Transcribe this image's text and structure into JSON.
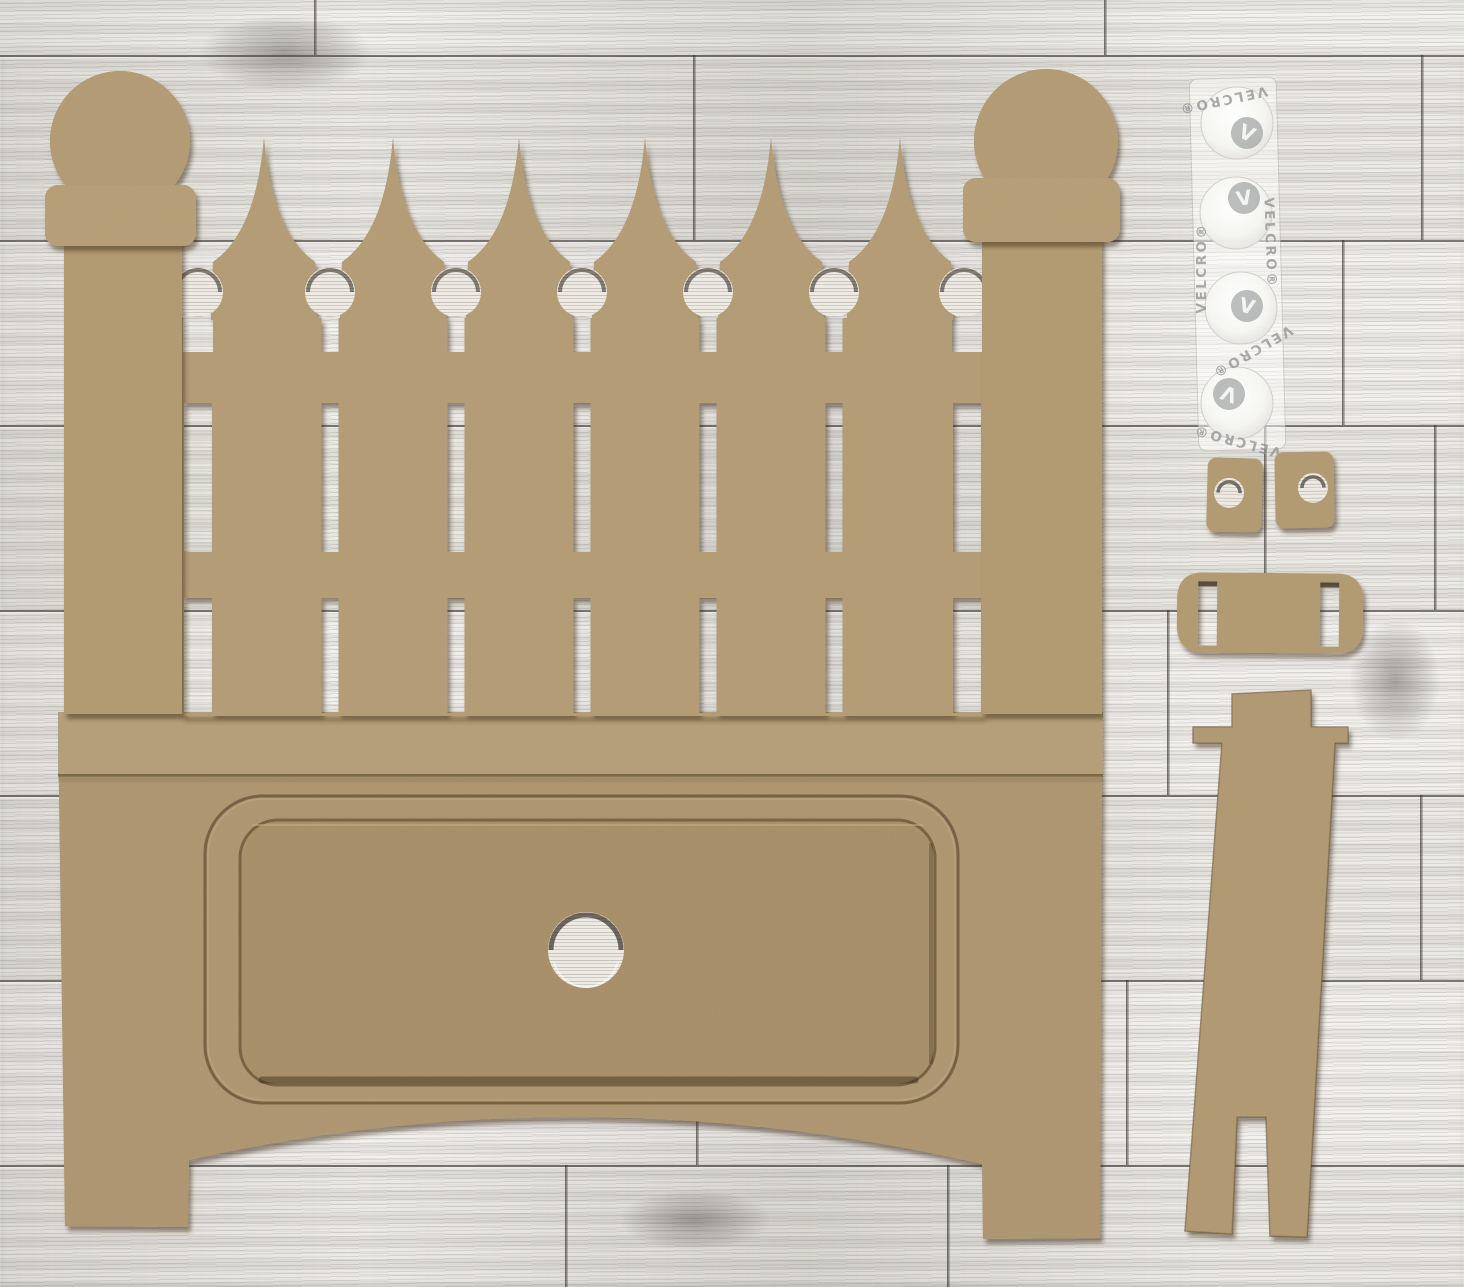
{
  "velcro": {
    "brand": "VELCRO®",
    "logo_letter": "V",
    "dot_count": 4
  },
  "pieces": {
    "fence_pickets": 6,
    "fence_posts": 2,
    "post_finials": 2,
    "velcro_dots": 4,
    "small_tabs_with_hole": 2,
    "slotted_connector_bars": 1,
    "easel_stands": 1
  },
  "colors": {
    "mdf_surface": "#b39b74",
    "mdf_rail": "#b5a07b",
    "mdf_pocket": "#a68e68",
    "cut_edge_shadow": "#3a2c18",
    "cut_interior_wood": "#edeae4",
    "background_wood": "#f1efec",
    "plank_seam": "#34312c",
    "velcro_gray": "#8f9092",
    "velcro_dot_white": "#ffffff"
  }
}
